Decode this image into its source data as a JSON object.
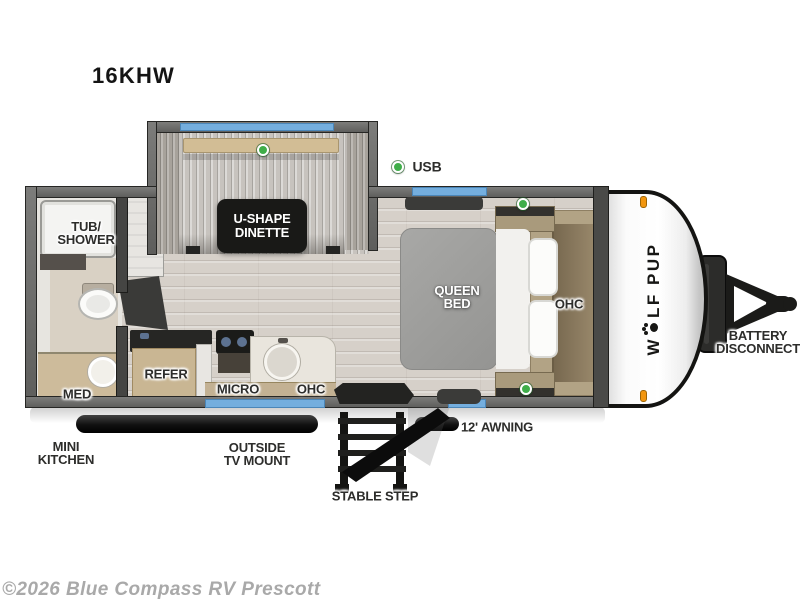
{
  "title": "16KHW",
  "watermark": "©2026 Blue Compass RV Prescott",
  "legend": {
    "usb": "USB"
  },
  "slideout": {
    "label1": "U-SHAPE",
    "label2": "DINETTE"
  },
  "bathroom": {
    "tub1": "TUB/",
    "tub2": "SHOWER",
    "med": "MED"
  },
  "kitchen": {
    "refer": "REFER",
    "micro": "MICRO",
    "ohc": "OHC"
  },
  "bedroom": {
    "bed1": "QUEEN",
    "bed2": "BED",
    "ohc": "OHC"
  },
  "exterior": {
    "mini1": "MINI",
    "mini2": "KITCHEN",
    "tv1": "OUTSIDE",
    "tv2": "TV MOUNT",
    "step": "STABLE STEP",
    "awning": "12' AWNING",
    "battery1": "BATTERY",
    "battery2": "DISCONNECT"
  },
  "brand": {
    "pre": "W",
    "post": "LF PUP"
  },
  "colors": {
    "floor": "#d6d0c9",
    "fabric": "#c7c3be",
    "window": "#74aede",
    "green": "#3fae49",
    "orange": "#f2960f",
    "label": "#2d2d2b",
    "wood": "#c9b693",
    "tan": "#b2a385",
    "watermark": "#a9a9a9"
  }
}
